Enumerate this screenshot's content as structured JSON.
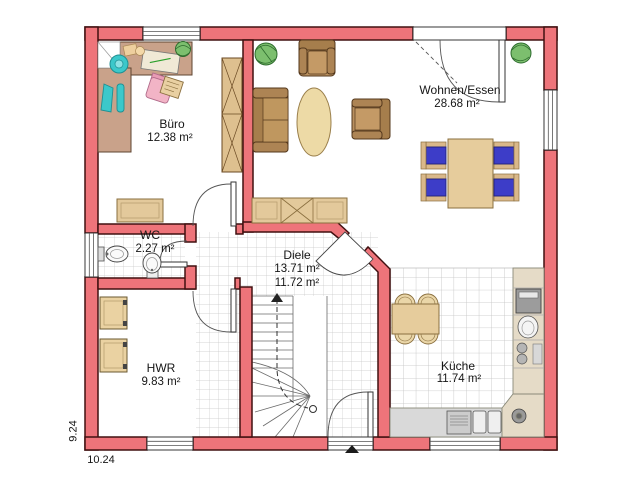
{
  "rooms": {
    "buero": {
      "name": "Büro",
      "area": "12.38 m²"
    },
    "wohnen": {
      "name": "Wohnen/Essen",
      "area": "28.68 m²"
    },
    "wc": {
      "name": "WC",
      "area": "2.27 m²"
    },
    "diele": {
      "name": "Diele",
      "area_total": "13.71 m²",
      "area_net": "11.72 m²"
    },
    "hwr": {
      "name": "HWR",
      "area": "9.83 m²"
    },
    "kueche": {
      "name": "Küche",
      "area": "11.74 m²"
    }
  },
  "dimensions": {
    "height_m": "9.24",
    "width_m": "10.24"
  },
  "colors": {
    "wall": "#ee747a",
    "wall_outline": "#401010",
    "tile_line": "#c8c8c8",
    "wood_dark": "#a67e4c",
    "wood_mid": "#b9905f",
    "wood_light": "#e3c99b",
    "table_cream": "#eddaa6",
    "chair_blue": "#3d3dc8",
    "chair_pink": "#f2b4c6",
    "teal": "#3cc8ca",
    "plant_green": "#7cbf6e",
    "counter_gray": "#d9d9d9",
    "counter_tan": "#e5dbc7",
    "desk_mauve": "#c9a28a"
  }
}
